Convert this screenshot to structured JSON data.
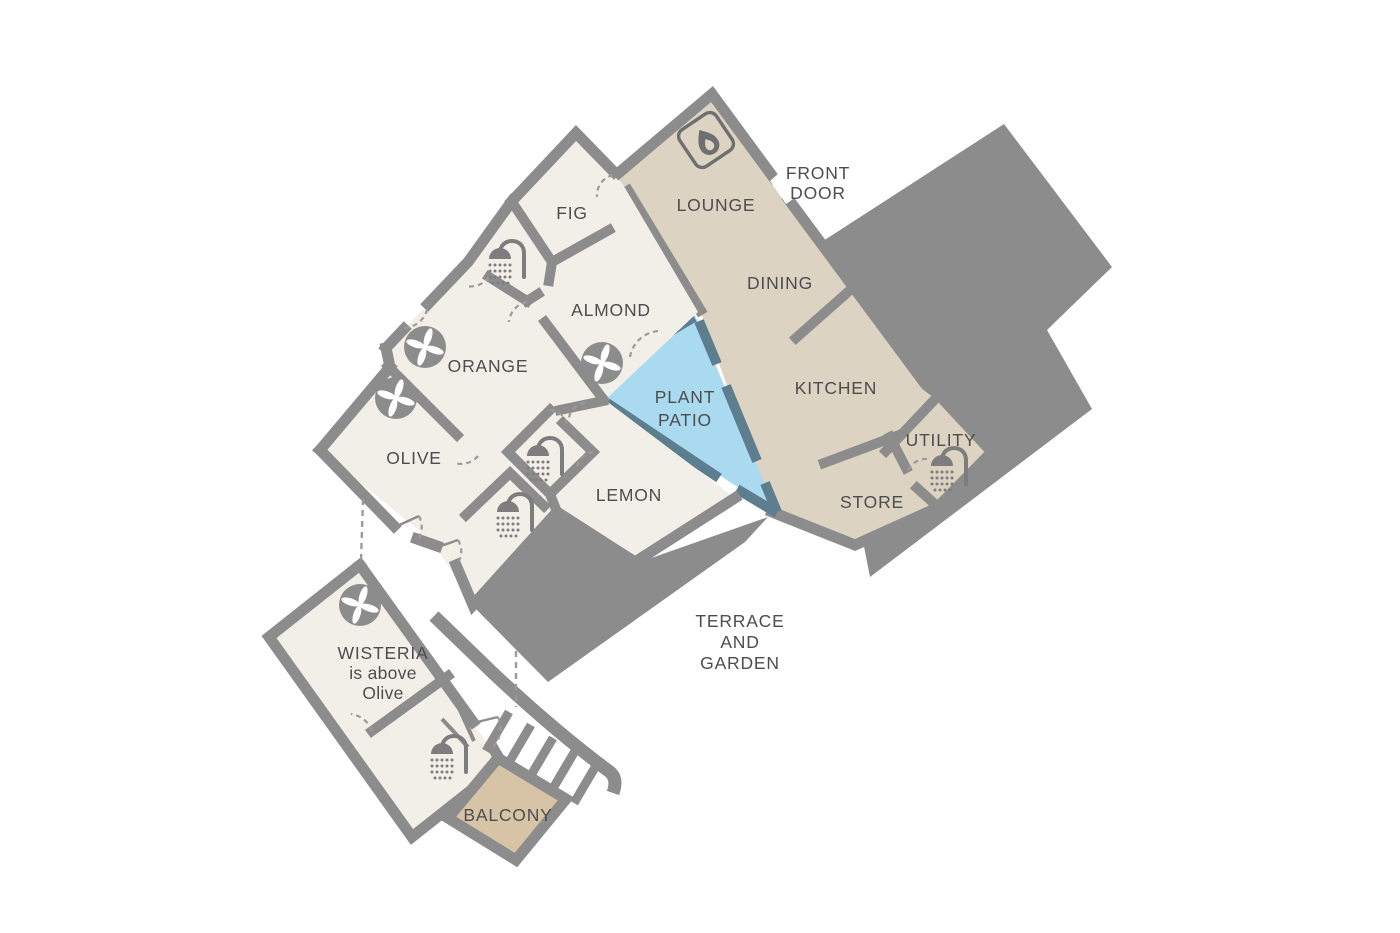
{
  "diagram": {
    "type": "floor-plan",
    "description": "Rotated holiday-house floor plan with bedroom wing, living wing, plant patio, terrace and separate upper-level wisteria room with balcony"
  },
  "colors": {
    "wall_gray": "#8c8c8c",
    "living_wing_floor": "#ddd3c2",
    "bedroom_wing_floor": "#f2efe9",
    "patio_blue": "#a9daf0",
    "patio_wall_slate": "#5d7e8f",
    "balcony_tan": "#d7c4a6",
    "label_text": "#4d4d4d",
    "door_dash": "#9b9b9b"
  },
  "rooms": {
    "lounge": "LOUNGE",
    "dining": "DINING",
    "kitchen": "KITCHEN",
    "utility": "UTILITY",
    "store": "STORE",
    "fig": "FIG",
    "almond": "ALMOND",
    "orange": "ORANGE",
    "olive": "OLIVE",
    "lemon": "LEMON",
    "balcony": "BALCONY"
  },
  "labels": {
    "front_door": [
      "FRONT",
      "DOOR"
    ],
    "plant_patio": [
      "PLANT",
      "PATIO"
    ],
    "terrace": [
      "TERRACE",
      "AND",
      "GARDEN"
    ],
    "wisteria_note": [
      "WISTERIA",
      "is above",
      "Olive"
    ]
  },
  "icons": {
    "fireplace": "fireplace-icon",
    "extractor_fan": "extractor-fan-icon",
    "shower": "shower-icon"
  }
}
